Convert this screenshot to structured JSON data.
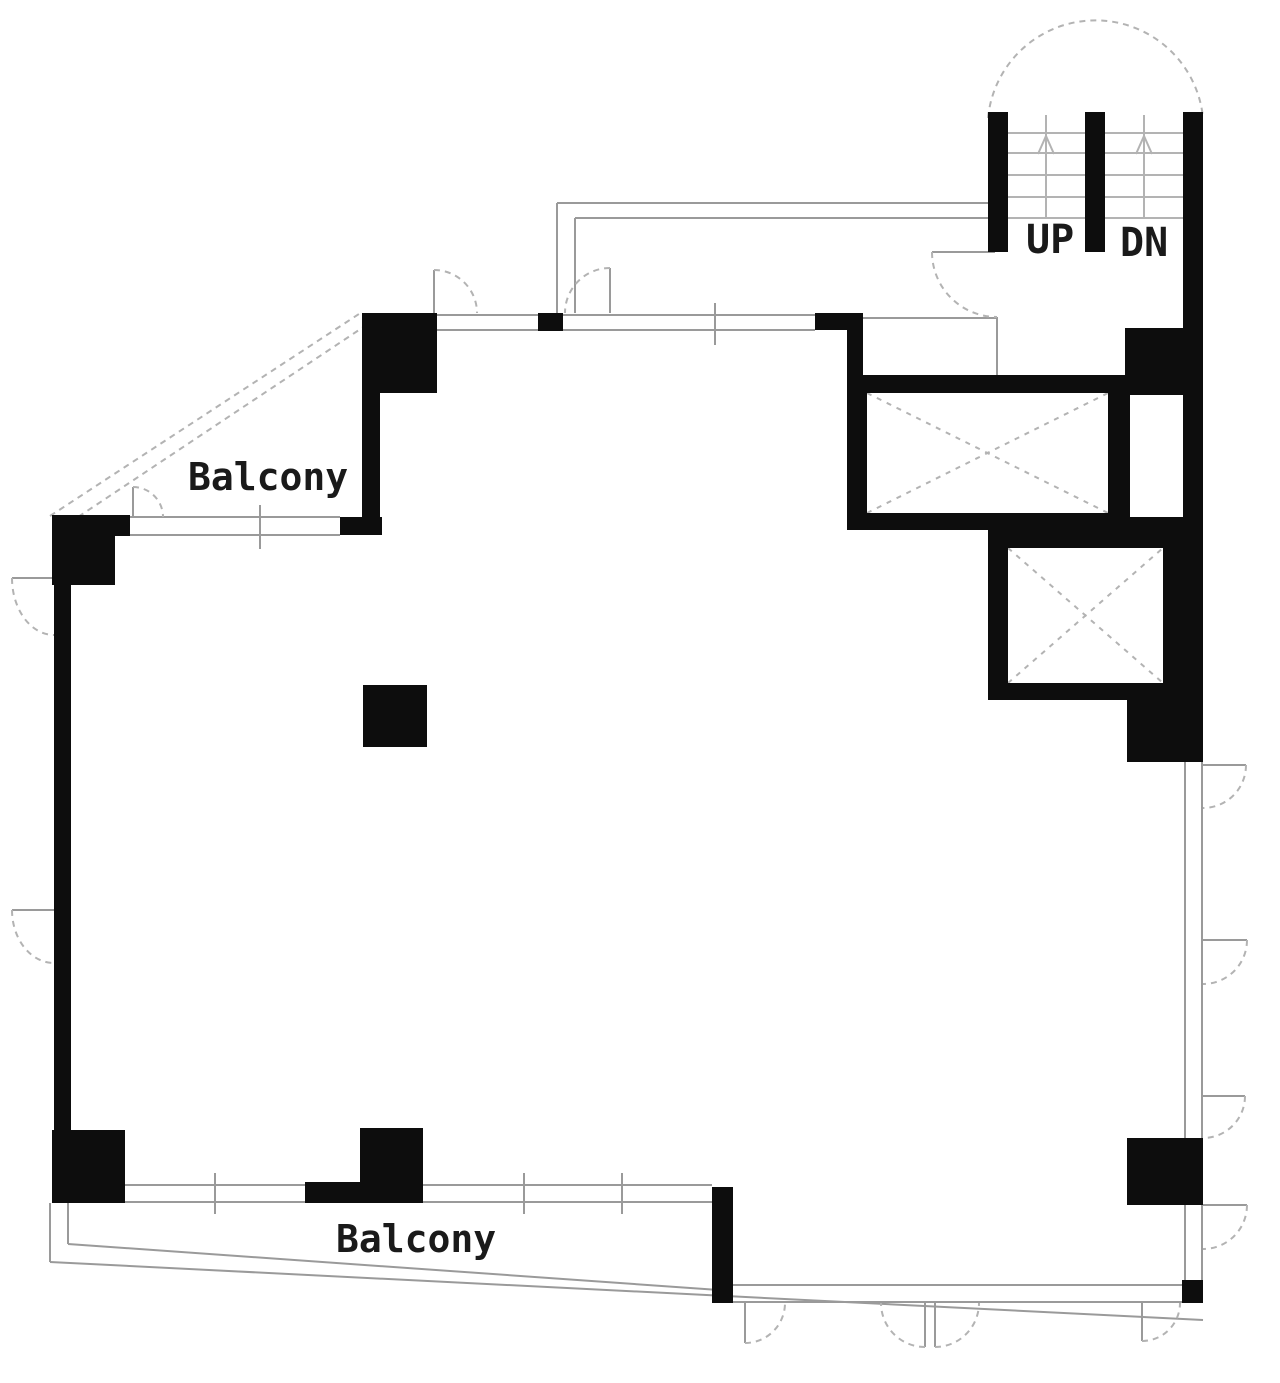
{
  "title": "building-floor-plan",
  "labels": {
    "balcony_upper": "Balcony",
    "balcony_lower": "Balcony",
    "stairs_up": "UP",
    "stairs_down": "DN"
  },
  "features": {
    "stairwell": "stairs with UP and DN flights under semicircular landing",
    "elevators": 2,
    "balconies": 2,
    "door_arcs": "swing doors on top wall, lobby, right wall, bottom wall",
    "free_column": 1
  },
  "colors": {
    "background": "#ffffff",
    "wall": "#0d0d0d",
    "line": "#9a9a9a",
    "line_light": "#b3b3b3",
    "text": "#1a1a1a"
  }
}
